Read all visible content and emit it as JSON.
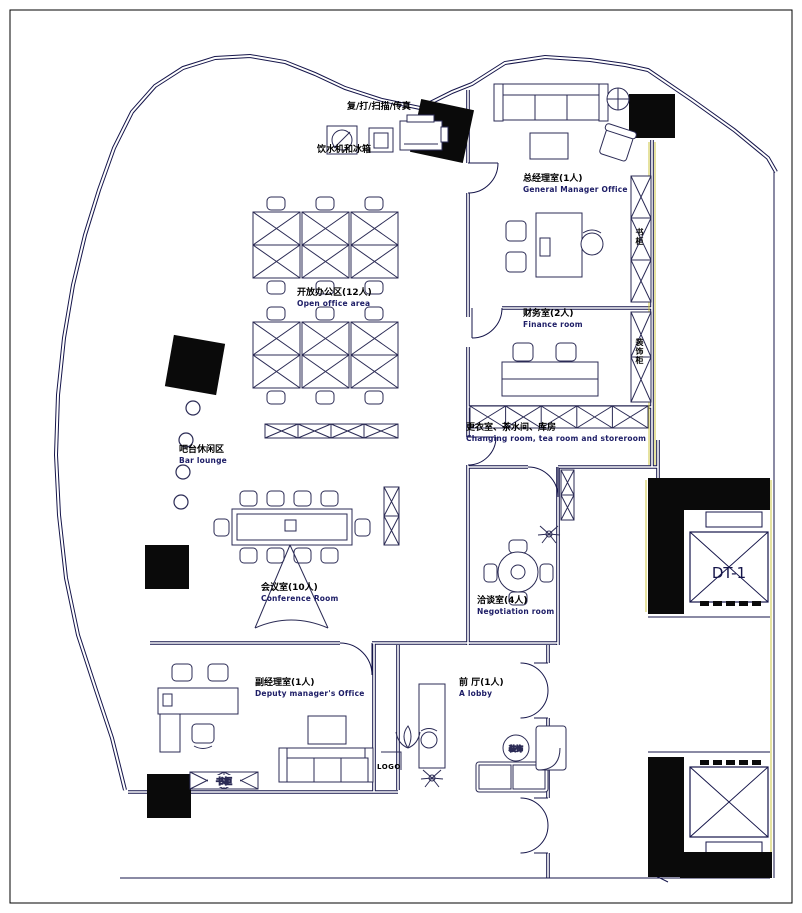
{
  "plan": {
    "rooms": {
      "open_office": {
        "zh": "开放办公区(12人)",
        "en": "Open office area"
      },
      "general_manager": {
        "zh": "总经理室(1人)",
        "en": "General Manager Office"
      },
      "finance": {
        "zh": "财务室(2人)",
        "en": "Finance room"
      },
      "changing": {
        "zh": "更衣室、茶水间、库房",
        "en": "Changing room, tea room and storeroom"
      },
      "bar_lounge": {
        "zh": "吧台休闲区",
        "en": "Bar lounge"
      },
      "conference": {
        "zh": "会议室(10人)",
        "en": "Conference Room"
      },
      "negotiation": {
        "zh": "洽谈室(4人)",
        "en": "Negotiation room"
      },
      "deputy_manager": {
        "zh": "副经理室(1人)",
        "en": "Deputy manager's Office"
      },
      "lobby": {
        "zh": "前 厅(1人)",
        "en": "A lobby"
      }
    },
    "annotations": {
      "copier": "复/打/扫描/传真",
      "water": "饮水机和冰箱",
      "logo": "LOGO",
      "decor_circle": "装饰",
      "bookcase_low": "书柜",
      "bookcase_wall": "书柜",
      "decor_cabinet_wall": "装饰柜",
      "elevator_id": "DT-1"
    },
    "colors": {
      "line": "#15154a",
      "wall_accent": "#c9bf2e",
      "column_fill": "#0a0a0a",
      "text_zh": "#000000",
      "text_en": "#1d1d66"
    }
  }
}
